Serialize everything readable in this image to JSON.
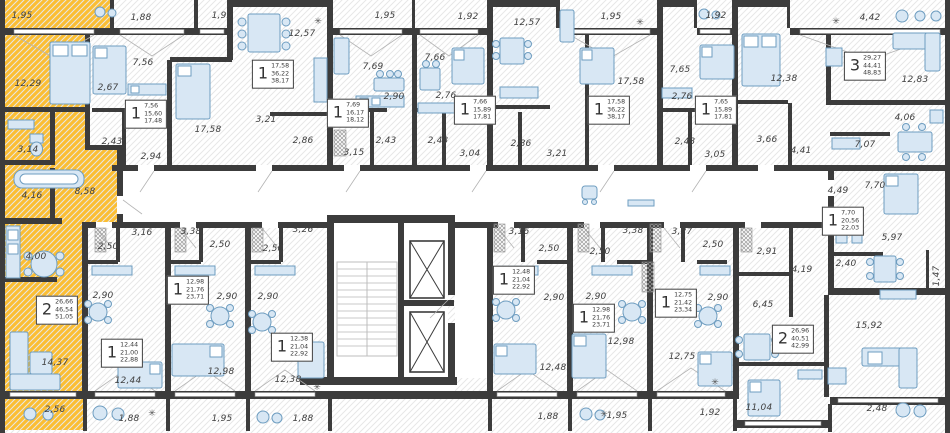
{
  "meta": {
    "type": "residential-floor-plan",
    "units": "m2"
  },
  "colors": {
    "highlight": "#FBBE33",
    "wall": "#3C3C3C",
    "furniture_fill": "#D8E7F4",
    "furniture_stroke": "#6E9DC0",
    "label_text": "#3F3F3F",
    "floor_hatch": "#E7E7E7"
  },
  "selected_apartment": {
    "rooms": "2",
    "areas": [
      "26,66",
      "46,54",
      "51,05"
    ]
  },
  "badges": [
    {
      "n": "2",
      "areas": [
        "26,66",
        "46,54",
        "51,05"
      ],
      "x": 57,
      "y": 310,
      "selected": true
    },
    {
      "n": "1",
      "areas": [
        "7,56",
        "15,60",
        "17,48"
      ],
      "x": 146,
      "y": 114,
      "selected": false
    },
    {
      "n": "1",
      "areas": [
        "17,58",
        "36,22",
        "38,17"
      ],
      "x": 273,
      "y": 74,
      "selected": false
    },
    {
      "n": "1",
      "areas": [
        "7,69",
        "16,17",
        "18,12"
      ],
      "x": 348,
      "y": 113,
      "selected": false
    },
    {
      "n": "1",
      "areas": [
        "7,66",
        "15,89",
        "17,81"
      ],
      "x": 475,
      "y": 110,
      "selected": false
    },
    {
      "n": "1",
      "areas": [
        "17,58",
        "36,22",
        "38,17"
      ],
      "x": 609,
      "y": 110,
      "selected": false
    },
    {
      "n": "1",
      "areas": [
        "7,65",
        "15,89",
        "17,81"
      ],
      "x": 716,
      "y": 110,
      "selected": false
    },
    {
      "n": "3",
      "areas": [
        "29,27",
        "44,41",
        "48,83"
      ],
      "x": 865,
      "y": 66,
      "selected": false
    },
    {
      "n": "1",
      "areas": [
        "7,70",
        "20,56",
        "22,03"
      ],
      "x": 843,
      "y": 221,
      "selected": false
    },
    {
      "n": "2",
      "areas": [
        "26,96",
        "40,51",
        "42,99"
      ],
      "x": 793,
      "y": 339,
      "selected": false
    },
    {
      "n": "1",
      "areas": [
        "12,44",
        "21,00",
        "22,88"
      ],
      "x": 122,
      "y": 353,
      "selected": false
    },
    {
      "n": "1",
      "areas": [
        "12,98",
        "21,76",
        "23,71"
      ],
      "x": 188,
      "y": 290,
      "selected": false
    },
    {
      "n": "1",
      "areas": [
        "12,38",
        "21,04",
        "22,92"
      ],
      "x": 292,
      "y": 347,
      "selected": false
    },
    {
      "n": "1",
      "areas": [
        "12,48",
        "21,04",
        "22,92"
      ],
      "x": 514,
      "y": 280,
      "selected": false
    },
    {
      "n": "1",
      "areas": [
        "12,98",
        "21,76",
        "23,71"
      ],
      "x": 594,
      "y": 318,
      "selected": false
    },
    {
      "n": "1",
      "areas": [
        "12,75",
        "21,42",
        "23,34"
      ],
      "x": 676,
      "y": 303,
      "selected": false
    }
  ],
  "room_labels": [
    {
      "t": "1,95",
      "x": 22,
      "y": 16
    },
    {
      "t": "1,88",
      "x": 141,
      "y": 18
    },
    {
      "t": "1,95",
      "x": 222,
      "y": 16
    },
    {
      "t": "1,95",
      "x": 385,
      "y": 16
    },
    {
      "t": "1,92",
      "x": 468,
      "y": 17
    },
    {
      "t": "1,95",
      "x": 611,
      "y": 17
    },
    {
      "t": "1,92",
      "x": 716,
      "y": 16
    },
    {
      "t": "4,42",
      "x": 870,
      "y": 18
    },
    {
      "t": "12,29",
      "x": 28,
      "y": 84
    },
    {
      "t": "3,14",
      "x": 28,
      "y": 150
    },
    {
      "t": "4,16",
      "x": 32,
      "y": 196
    },
    {
      "t": "8,58",
      "x": 85,
      "y": 192
    },
    {
      "t": "4,00",
      "x": 36,
      "y": 257
    },
    {
      "t": "14,37",
      "x": 55,
      "y": 363
    },
    {
      "t": "2,56",
      "x": 55,
      "y": 410
    },
    {
      "t": "7,56",
      "x": 143,
      "y": 63
    },
    {
      "t": "2,67",
      "x": 108,
      "y": 88
    },
    {
      "t": "2,43",
      "x": 112,
      "y": 142
    },
    {
      "t": "2,94",
      "x": 151,
      "y": 157
    },
    {
      "t": "12,57",
      "x": 302,
      "y": 34
    },
    {
      "t": "17,58",
      "x": 208,
      "y": 130
    },
    {
      "t": "3,21",
      "x": 266,
      "y": 120
    },
    {
      "t": "2,86",
      "x": 303,
      "y": 141
    },
    {
      "t": "7,69",
      "x": 373,
      "y": 67
    },
    {
      "t": "2,90",
      "x": 394,
      "y": 97
    },
    {
      "t": "2,43",
      "x": 386,
      "y": 141
    },
    {
      "t": "3,15",
      "x": 354,
      "y": 153
    },
    {
      "t": "7,66",
      "x": 435,
      "y": 58
    },
    {
      "t": "2,76",
      "x": 446,
      "y": 96
    },
    {
      "t": "2,43",
      "x": 438,
      "y": 141
    },
    {
      "t": "3,04",
      "x": 470,
      "y": 154
    },
    {
      "t": "12,57",
      "x": 527,
      "y": 23
    },
    {
      "t": "17,58",
      "x": 631,
      "y": 82
    },
    {
      "t": "2,86",
      "x": 521,
      "y": 144
    },
    {
      "t": "3,21",
      "x": 557,
      "y": 154
    },
    {
      "t": "7,65",
      "x": 680,
      "y": 70
    },
    {
      "t": "2,76",
      "x": 682,
      "y": 97
    },
    {
      "t": "2,43",
      "x": 685,
      "y": 142
    },
    {
      "t": "3,05",
      "x": 715,
      "y": 155
    },
    {
      "t": "12,38",
      "x": 784,
      "y": 79
    },
    {
      "t": "3,66",
      "x": 767,
      "y": 140
    },
    {
      "t": "4,41",
      "x": 801,
      "y": 151
    },
    {
      "t": "12,83",
      "x": 915,
      "y": 80
    },
    {
      "t": "4,06",
      "x": 905,
      "y": 118
    },
    {
      "t": "7,07",
      "x": 865,
      "y": 145
    },
    {
      "t": "4,49",
      "x": 838,
      "y": 191
    },
    {
      "t": "7,70",
      "x": 875,
      "y": 186
    },
    {
      "t": "5,97",
      "x": 892,
      "y": 238
    },
    {
      "t": "2,40",
      "x": 846,
      "y": 264
    },
    {
      "t": "1,47",
      "x": 937,
      "y": 276,
      "rot": true
    },
    {
      "t": "2,91",
      "x": 767,
      "y": 252
    },
    {
      "t": "4,19",
      "x": 802,
      "y": 270
    },
    {
      "t": "6,45",
      "x": 763,
      "y": 305
    },
    {
      "t": "11,04",
      "x": 759,
      "y": 408
    },
    {
      "t": "15,92",
      "x": 869,
      "y": 326
    },
    {
      "t": "2,48",
      "x": 877,
      "y": 409
    },
    {
      "t": "3,16",
      "x": 142,
      "y": 233
    },
    {
      "t": "2,50",
      "x": 108,
      "y": 247
    },
    {
      "t": "2,90",
      "x": 103,
      "y": 296
    },
    {
      "t": "12,44",
      "x": 128,
      "y": 381
    },
    {
      "t": "1,88",
      "x": 129,
      "y": 419
    },
    {
      "t": "3,38",
      "x": 191,
      "y": 232
    },
    {
      "t": "2,50",
      "x": 220,
      "y": 245
    },
    {
      "t": "2,90",
      "x": 227,
      "y": 297
    },
    {
      "t": "12,98",
      "x": 221,
      "y": 372
    },
    {
      "t": "1,95",
      "x": 222,
      "y": 419
    },
    {
      "t": "3,26",
      "x": 303,
      "y": 230
    },
    {
      "t": "2,50",
      "x": 273,
      "y": 249
    },
    {
      "t": "2,90",
      "x": 268,
      "y": 297
    },
    {
      "t": "12,38",
      "x": 288,
      "y": 380
    },
    {
      "t": "1,88",
      "x": 303,
      "y": 419
    },
    {
      "t": "3,16",
      "x": 519,
      "y": 232
    },
    {
      "t": "2,50",
      "x": 549,
      "y": 249
    },
    {
      "t": "2,90",
      "x": 554,
      "y": 298
    },
    {
      "t": "12,48",
      "x": 553,
      "y": 368
    },
    {
      "t": "1,88",
      "x": 548,
      "y": 417
    },
    {
      "t": "3,38",
      "x": 633,
      "y": 231
    },
    {
      "t": "2,50",
      "x": 600,
      "y": 252
    },
    {
      "t": "2,90",
      "x": 596,
      "y": 297
    },
    {
      "t": "12,98",
      "x": 621,
      "y": 342
    },
    {
      "t": "1,95",
      "x": 617,
      "y": 416
    },
    {
      "t": "3,27",
      "x": 682,
      "y": 232
    },
    {
      "t": "2,50",
      "x": 713,
      "y": 245
    },
    {
      "t": "2,90",
      "x": 718,
      "y": 298
    },
    {
      "t": "12,75",
      "x": 682,
      "y": 357
    },
    {
      "t": "1,92",
      "x": 710,
      "y": 413
    }
  ]
}
